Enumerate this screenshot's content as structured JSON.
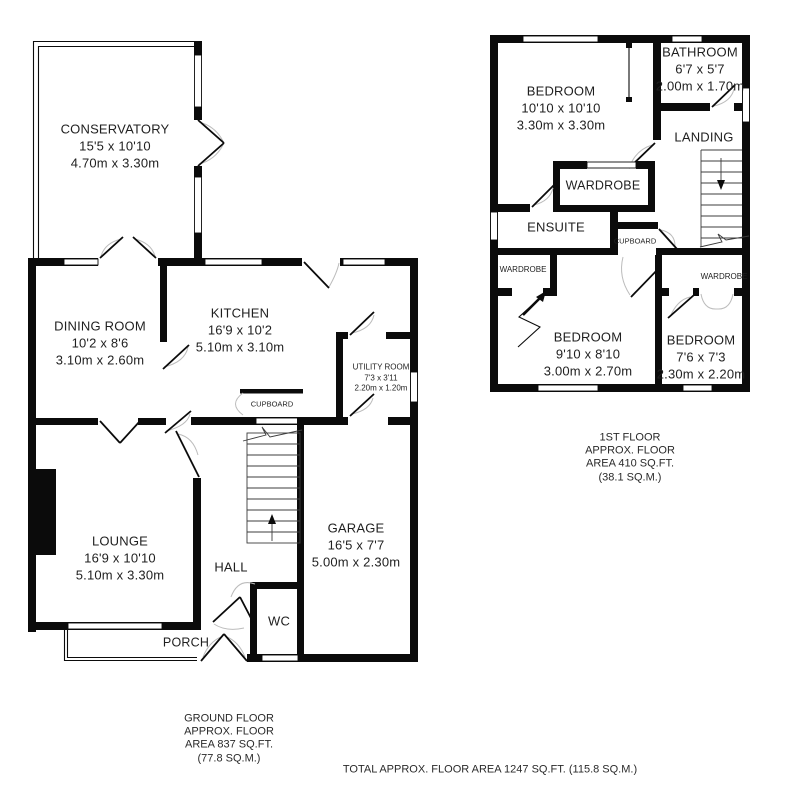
{
  "ground_floor": {
    "rooms": {
      "conservatory": {
        "name": "CONSERVATORY",
        "imperial": "15'5 x 10'10",
        "metric": "4.70m x 3.30m"
      },
      "dining_room": {
        "name": "DINING ROOM",
        "imperial": "10'2 x 8'6",
        "metric": "3.10m x 2.60m"
      },
      "kitchen": {
        "name": "KITCHEN",
        "imperial": "16'9 x 10'2",
        "metric": "5.10m x 3.10m"
      },
      "utility_room": {
        "name": "UTILITY ROOM",
        "imperial": "7'3 x 3'11",
        "metric": "2.20m x 1.20m"
      },
      "cupboard": {
        "name": "CUPBOARD"
      },
      "lounge": {
        "name": "LOUNGE",
        "imperial": "16'9 x 10'10",
        "metric": "5.10m x 3.30m"
      },
      "hall": {
        "name": "HALL"
      },
      "garage": {
        "name": "GARAGE",
        "imperial": "16'5 x 7'7",
        "metric": "5.00m x 2.30m"
      },
      "wc": {
        "name": "WC"
      },
      "porch": {
        "name": "PORCH"
      }
    },
    "caption": {
      "l1": "GROUND FLOOR",
      "l2": "APPROX. FLOOR",
      "l3": "AREA 837 SQ.FT.",
      "l4": "(77.8 SQ.M.)"
    }
  },
  "first_floor": {
    "rooms": {
      "bedroom_1": {
        "name": "BEDROOM",
        "imperial": "10'10 x 10'10",
        "metric": "3.30m x 3.30m"
      },
      "bathroom": {
        "name": "BATHROOM",
        "imperial": "6'7 x 5'7",
        "metric": "2.00m x 1.70m"
      },
      "landing": {
        "name": "LANDING"
      },
      "wardrobe_top": {
        "name": "WARDROBE"
      },
      "ensuite": {
        "name": "ENSUITE"
      },
      "cupboard": {
        "name": "CUPBOARD"
      },
      "wardrobe_left": {
        "name": "WARDROBE"
      },
      "wardrobe_right": {
        "name": "WARDROBE"
      },
      "bedroom_2": {
        "name": "BEDROOM",
        "imperial": "9'10 x 8'10",
        "metric": "3.00m x 2.70m"
      },
      "bedroom_3": {
        "name": "BEDROOM",
        "imperial": "7'6 x 7'3",
        "metric": "2.30m x 2.20m"
      }
    },
    "caption": {
      "l1": "1ST FLOOR",
      "l2": "APPROX. FLOOR",
      "l3": "AREA 410 SQ.FT.",
      "l4": "(38.1 SQ.M.)"
    }
  },
  "footer": {
    "total": "TOTAL APPROX. FLOOR AREA 1247 SQ.FT. (115.8 SQ.M.)"
  },
  "colors": {
    "walls": "#0b0b0b",
    "door_arc": "#bcbcbc",
    "background": "#ffffff"
  }
}
